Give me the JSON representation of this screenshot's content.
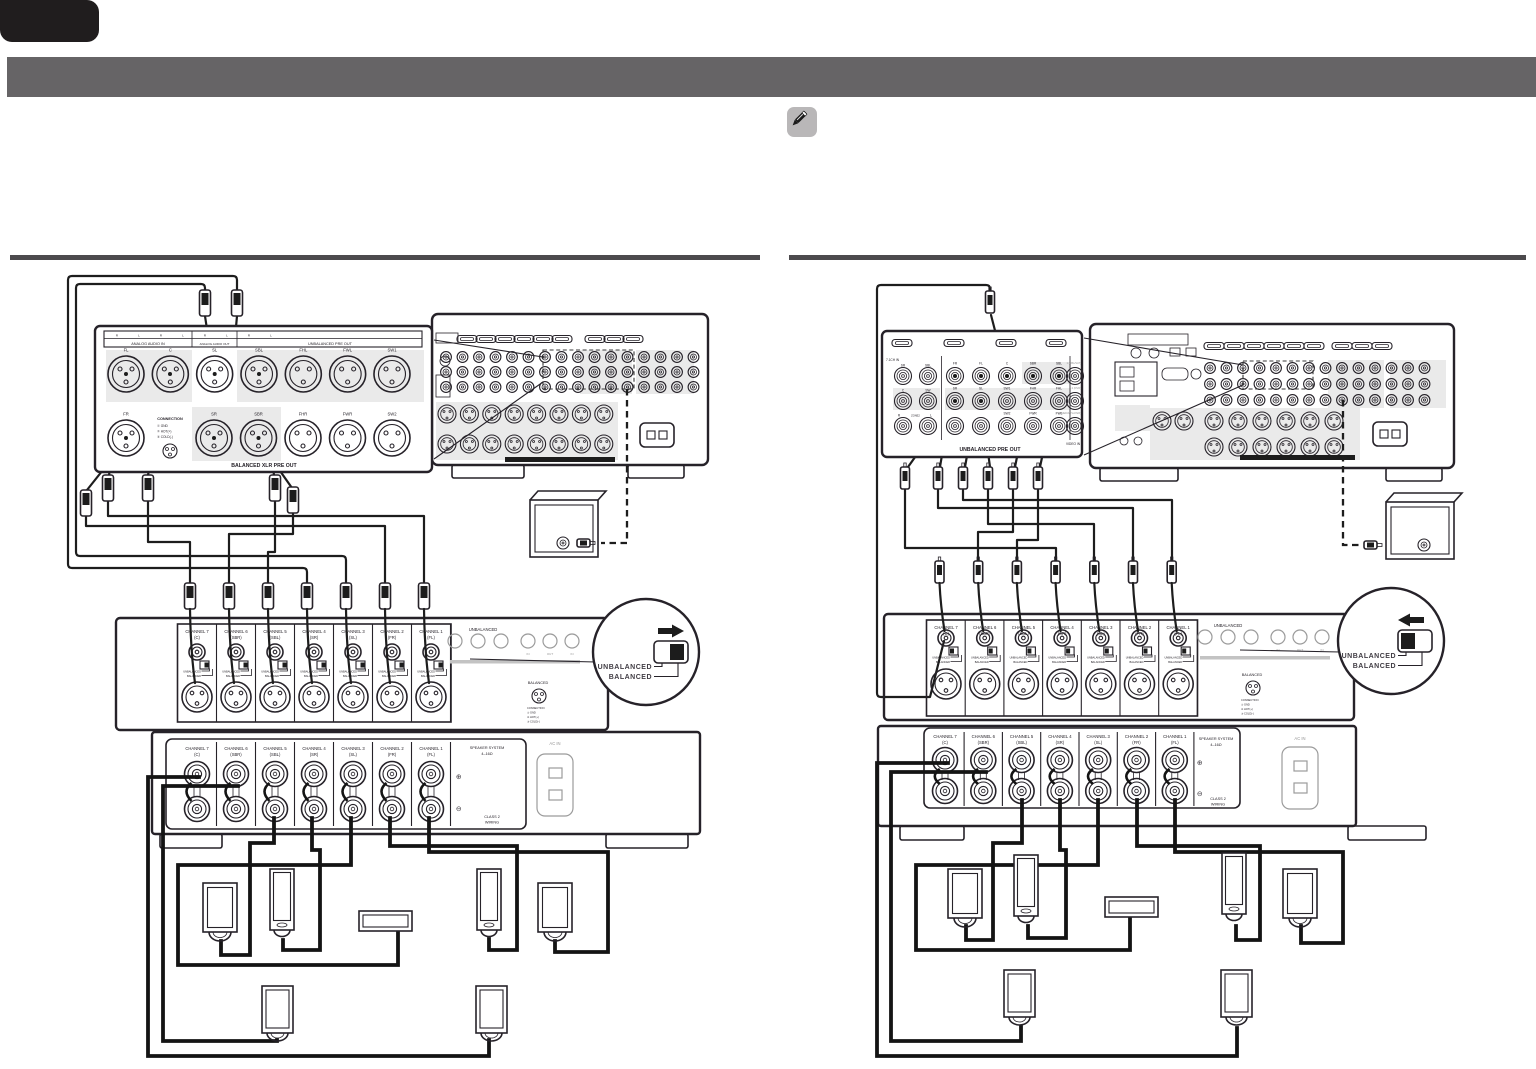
{
  "colors": {
    "banner": "#666466",
    "tab": "#201d1e",
    "rule": "#4c4a4d",
    "note_bg": "#b9b7b8"
  },
  "left_callout": {
    "header_rl": [
      "R",
      "L",
      "R",
      "L",
      "R",
      "L",
      "R",
      "L"
    ],
    "sections": [
      "ANALOG AUDIO IN",
      "ANALOG AUDIO OUT",
      "UNBALANCED PRE OUT"
    ],
    "row1": [
      "FL",
      "C",
      "SL",
      "SBL",
      "FHL",
      "FWL",
      "SW1"
    ],
    "row2_first": "FR",
    "row2": [
      "SR",
      "SBR",
      "FHR",
      "FWR",
      "SW2"
    ],
    "connection": {
      "title": "CONNECTION",
      "pins": [
        "① GND",
        "② HOT(+)",
        "③ COLD(-)"
      ]
    },
    "footer": "BALANCED XLR PRE OUT"
  },
  "right_callout": {
    "corner": "7.1CH IN",
    "left_col_row1": [
      "SR",
      "SBL"
    ],
    "left_col_row2": [
      "C",
      "SW"
    ],
    "zone2": [
      "R",
      "ZONE2",
      "L"
    ],
    "row1": [
      "FR",
      "FL",
      "C",
      "SBR",
      "SBL"
    ],
    "row2": [
      "SR",
      "SL",
      "SW1",
      "FHR",
      "FHL"
    ],
    "row3": [
      "SW2",
      "FWR",
      "FWL"
    ],
    "inputs": [
      "1 (CBL/SAT)",
      "2 (DVD)",
      "3 (MEDIA PLAYER)"
    ],
    "video_in": "VIDEO IN",
    "footer": "UNBALANCED PRE OUT"
  },
  "switch_callout": {
    "unbalanced": "UNBALANCED",
    "balanced": "BALANCED"
  },
  "amplifier": {
    "channels": [
      {
        "name": "CHANNEL 7",
        "speaker": "(C)"
      },
      {
        "name": "CHANNEL 6",
        "speaker": "(SBR)"
      },
      {
        "name": "CHANNEL 5",
        "speaker": "(SBL)"
      },
      {
        "name": "CHANNEL 4",
        "speaker": "(SR)"
      },
      {
        "name": "CHANNEL 3",
        "speaker": "(SL)"
      },
      {
        "name": "CHANNEL 2",
        "speaker": "(FR)"
      },
      {
        "name": "CHANNEL 1",
        "speaker": "(FL)"
      }
    ],
    "switch_small": {
      "u": "UNBALANCED",
      "b": "BALANCED"
    },
    "unbalanced_label": "UNBALANCED",
    "io": [
      "IN",
      "OUT",
      "IN"
    ],
    "balanced_label": "BALANCED",
    "balanced_note": [
      "CONNECTION",
      "① GND",
      "② HOT(+)",
      "③ COLD(-)"
    ],
    "speaker_system": [
      "SPEAKER SYSTEM",
      "4–16Ω"
    ],
    "polarity": {
      "plus": "⊕",
      "minus": "⊖"
    },
    "class_wiring": [
      "CLASS 2",
      "WIRING"
    ],
    "ac_in": "AC IN"
  }
}
